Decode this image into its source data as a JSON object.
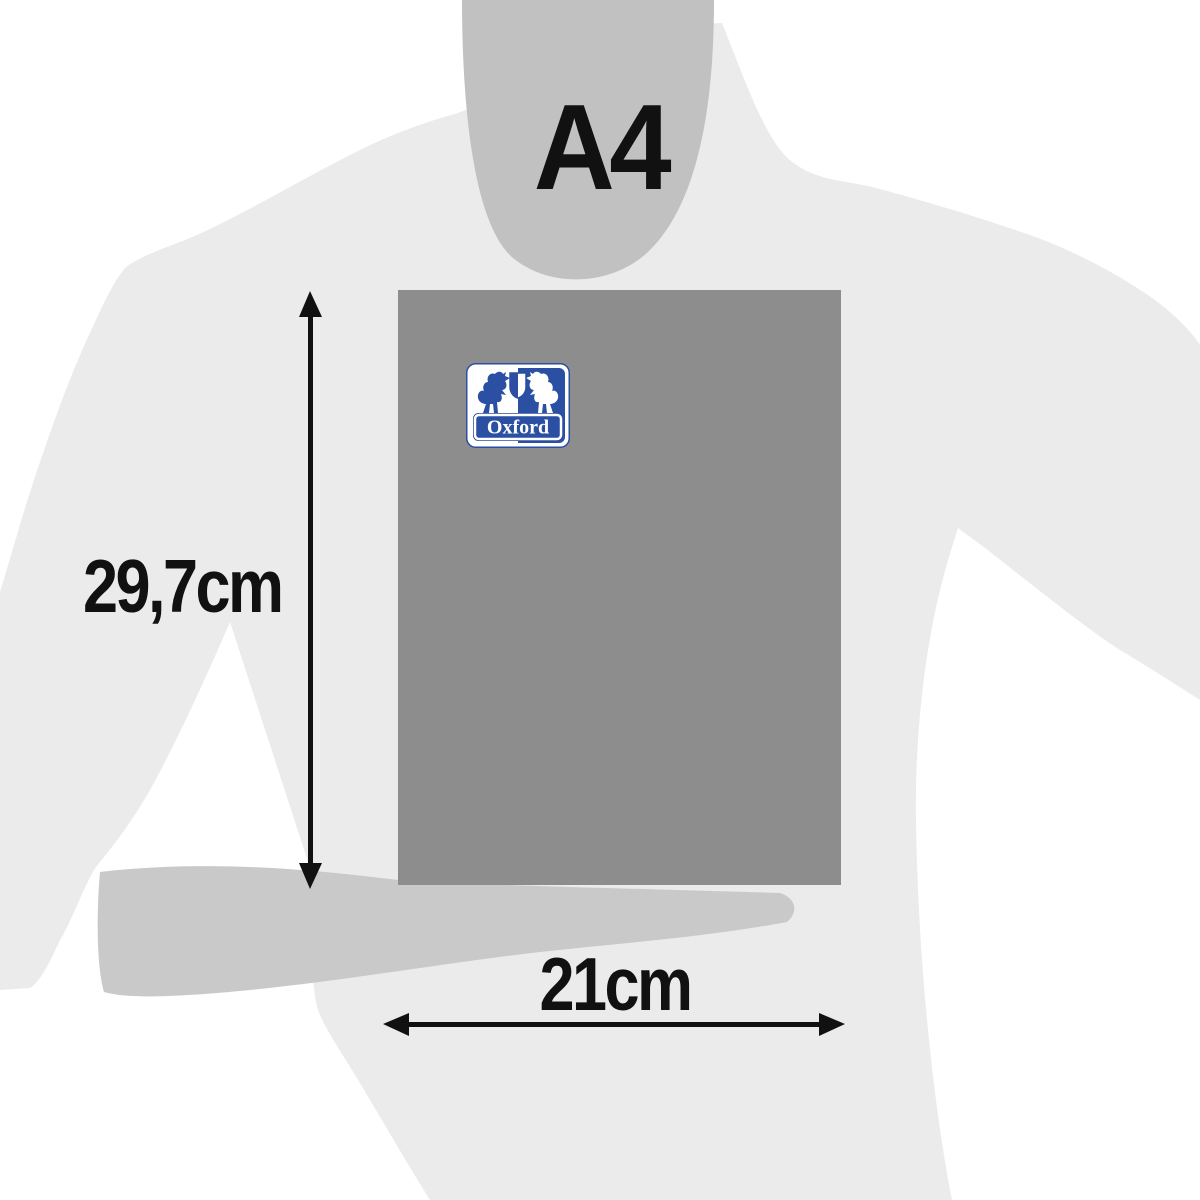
{
  "figure": {
    "size_name": "A4",
    "height_label": "29,7cm",
    "width_label": "21cm"
  },
  "notebook": {
    "brand": "Oxford",
    "cover_color": "#8d8d8d",
    "logo_blue": "#2b4fa2",
    "logo_white": "#ffffff"
  },
  "silhouette": {
    "shirt_color": "#ebebeb",
    "neck_color": "#c1c1c1",
    "arm_color": "#c9c9c9"
  },
  "annotation": {
    "arrow_color": "#111111",
    "text_color": "#111111"
  },
  "icons": {
    "logo": "oxford-logo",
    "lion_left": "lion-left-icon",
    "lion_right": "lion-right-icon",
    "shield": "shield-icon",
    "height_arrow": "height-dimension-arrow",
    "width_arrow": "width-dimension-arrow"
  }
}
